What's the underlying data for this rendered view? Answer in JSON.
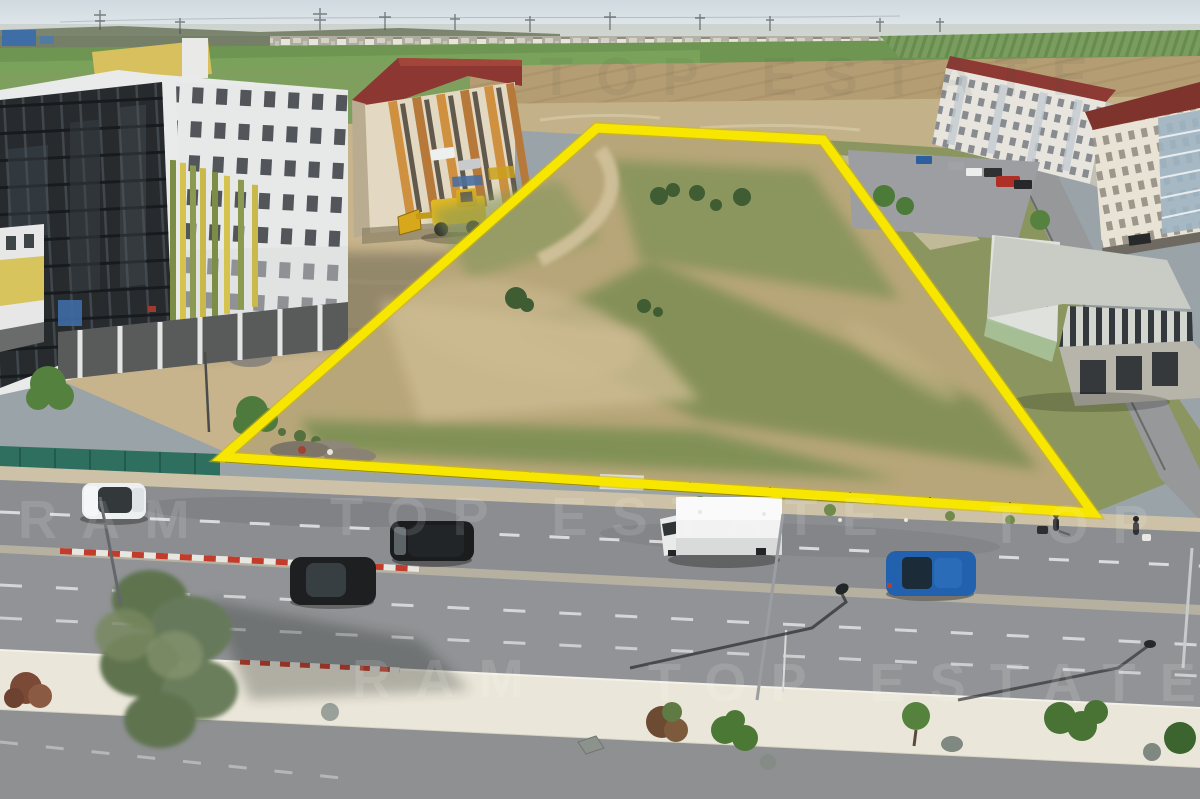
{
  "image": {
    "kind": "aerial-drone-photograph",
    "width_px": 1200,
    "height_px": 799
  },
  "watermark": {
    "primary": "TOP ESTATE",
    "secondary": "RAM"
  },
  "plot": {
    "outline_color": "#F7E600",
    "outline_width_px": 9,
    "corners_px": [
      [
        597,
        128
      ],
      [
        823,
        140
      ],
      [
        1093,
        513
      ],
      [
        223,
        457
      ]
    ],
    "ground": "vacant lot with patchy grass, bare earth, dirt paths, scattered bushes"
  },
  "scene": {
    "sky": "pale hazy blue",
    "horizon": "row of distant white houses, power pylons, green and plowed fields",
    "left": "multi-storey building under construction with dark glass curtain wall",
    "mid_left": "red-roofed apartment block with orange striped facade, yellow wheel loader",
    "right": "white apartment blocks with dark red roofs and parking lot",
    "mid_right": "unfinished white concrete commercial building with slatted parapet",
    "foreground": "multi-lane boulevard, gravel landscaped median with shrubs, rocks and olive tree",
    "fence": "teal construction mesh fence along site boundary"
  },
  "palette": {
    "sky": "#cfd9df",
    "field_green": "#6f9552",
    "plowed_field": "#b59d73",
    "plot_dirt": "#b7a679",
    "plot_grass": "#7d9054",
    "asphalt": "#8b8d90",
    "gravel_median": "#eae6d9",
    "roof_red": "#8c3a33",
    "glass_facade": "#272b2e",
    "fence_teal": "#2e6f60",
    "loader_yellow": "#e6b91e",
    "curb_red": "#c23b2b"
  },
  "vehicles": [
    {
      "type": "suv",
      "color": "white"
    },
    {
      "type": "minivan",
      "color": "black"
    },
    {
      "type": "box-van",
      "color": "white"
    },
    {
      "type": "hatchback",
      "color": "dark-gray"
    },
    {
      "type": "suv",
      "color": "blue"
    },
    {
      "type": "parked-cars",
      "colors": [
        "blue",
        "white",
        "red",
        "black"
      ]
    }
  ],
  "pedestrians": 2
}
